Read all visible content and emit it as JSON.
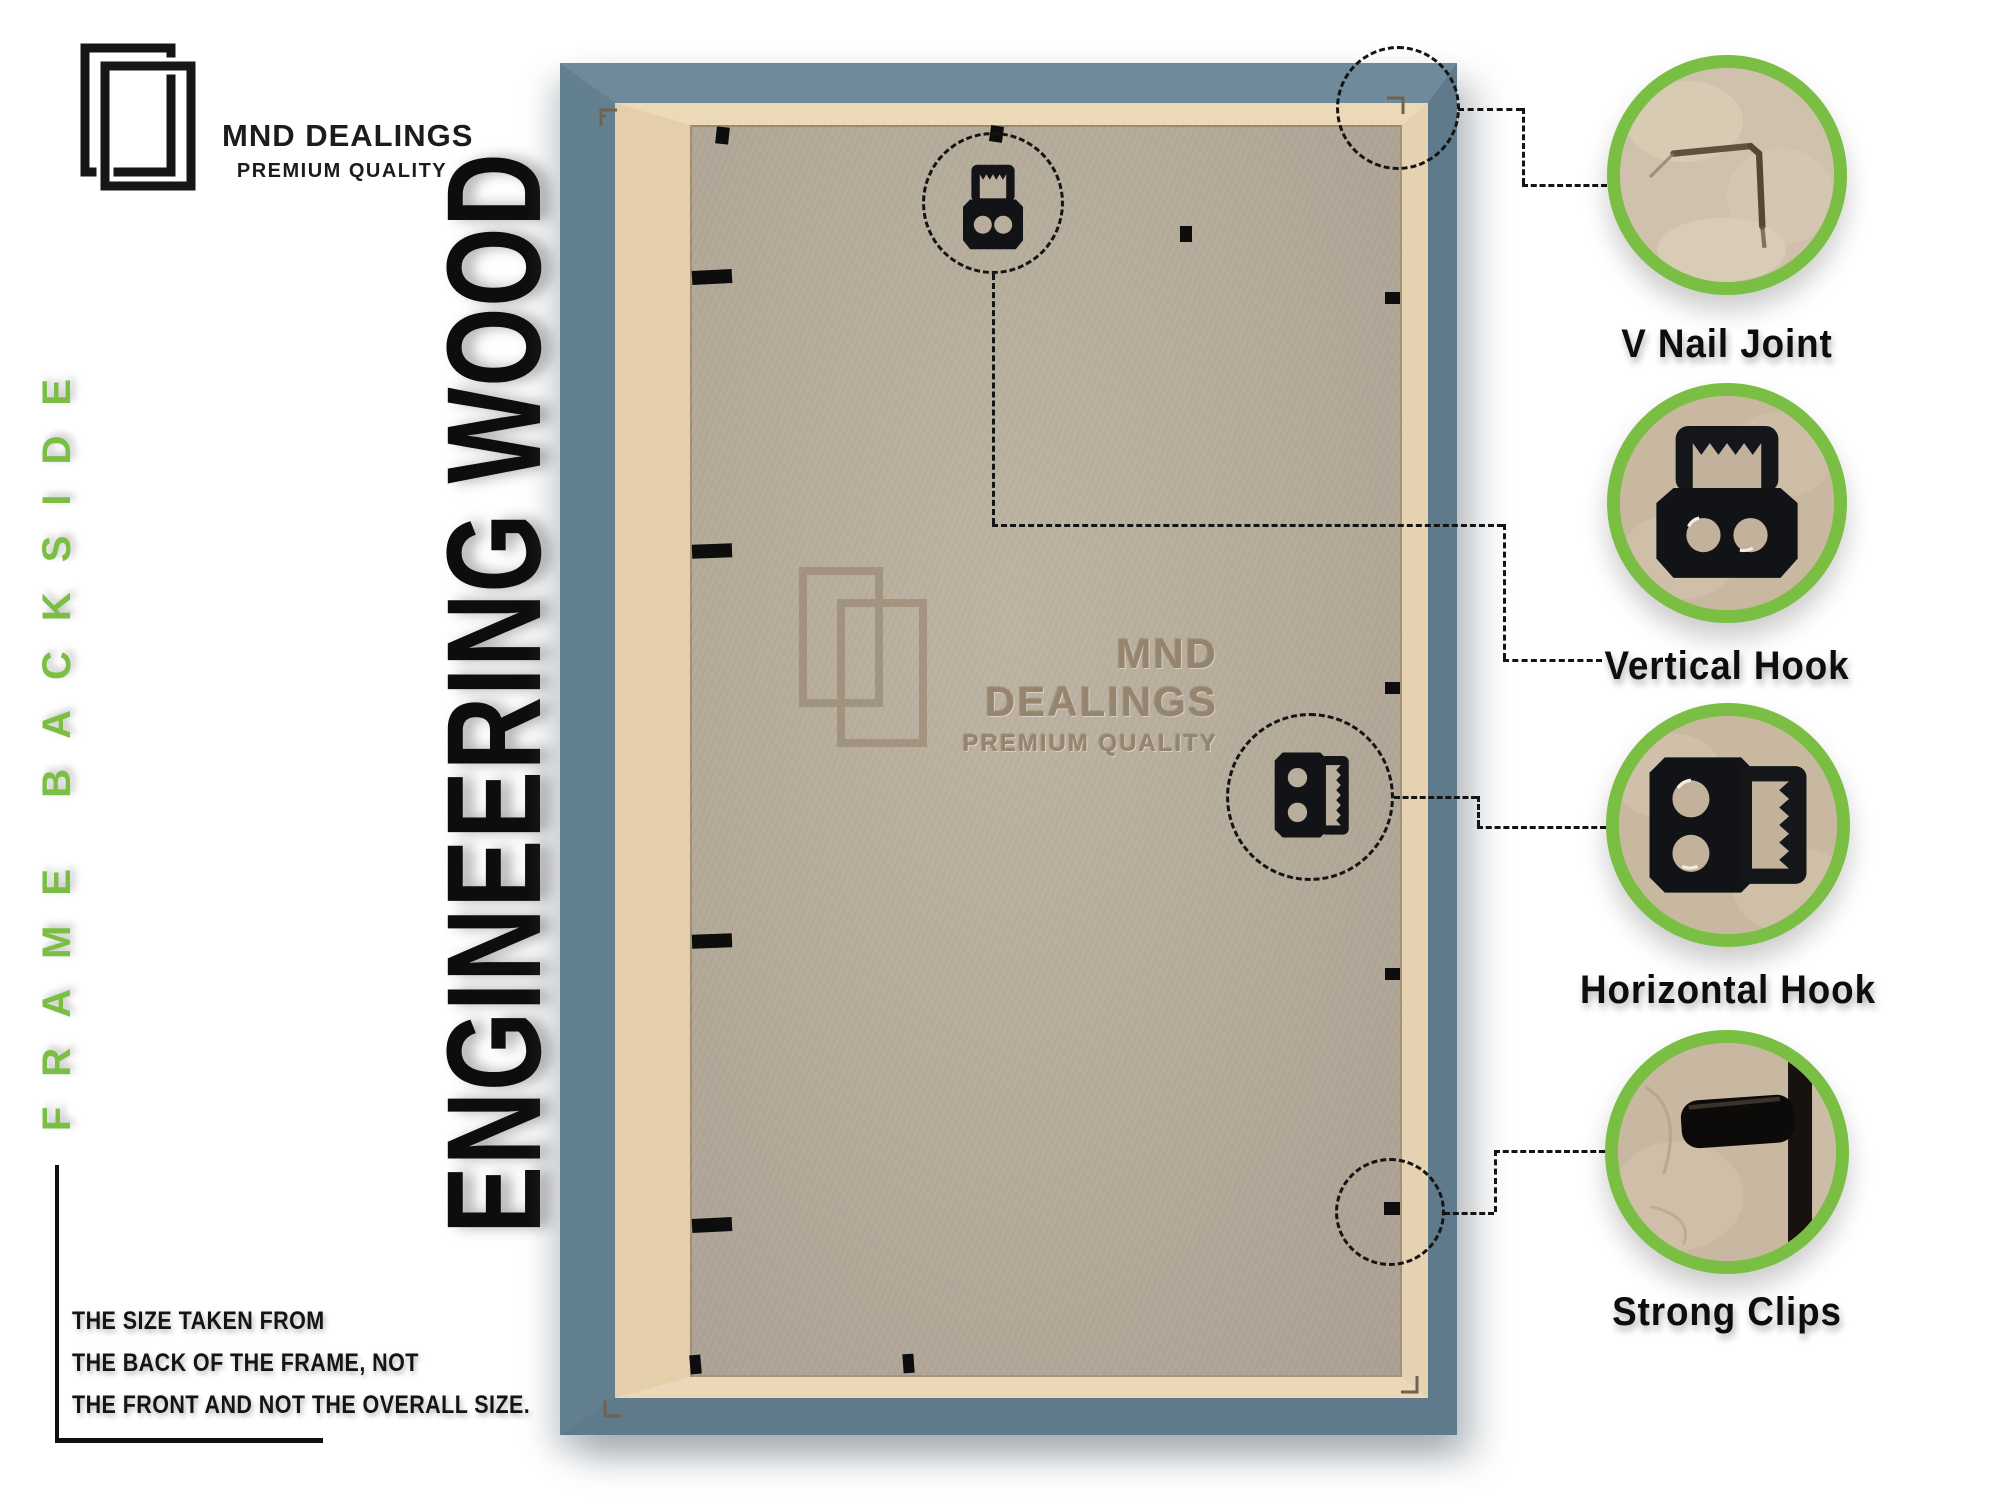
{
  "brand": {
    "name": "MND DEALINGS",
    "tagline": "PREMIUM QUALITY"
  },
  "left_rail": {
    "side_text": "FRAME BACKSIDE",
    "material_text": "ENGINEERING WOOD"
  },
  "note": {
    "lines": [
      "THE SIZE TAKEN FROM",
      "THE BACK OF THE FRAME, NOT",
      "THE FRONT AND NOT THE OVERALL SIZE."
    ]
  },
  "watermark": {
    "name": "MND DEALINGS",
    "tagline": "PREMIUM QUALITY"
  },
  "callouts": [
    {
      "id": "v-nail-joint",
      "label": "V Nail Joint"
    },
    {
      "id": "vertical-hook",
      "label": "Vertical Hook"
    },
    {
      "id": "horizontal-hook",
      "label": "Horizontal Hook"
    },
    {
      "id": "strong-clips",
      "label": "Strong Clips"
    }
  ],
  "colors": {
    "accent_green": "#7abf44",
    "frame_blue": "#63808f",
    "board_edge_cream": "#e8d5b5",
    "backing_tan": "#b4aa99",
    "ink": "#121212",
    "watermark_brown": "#8d7a63"
  }
}
